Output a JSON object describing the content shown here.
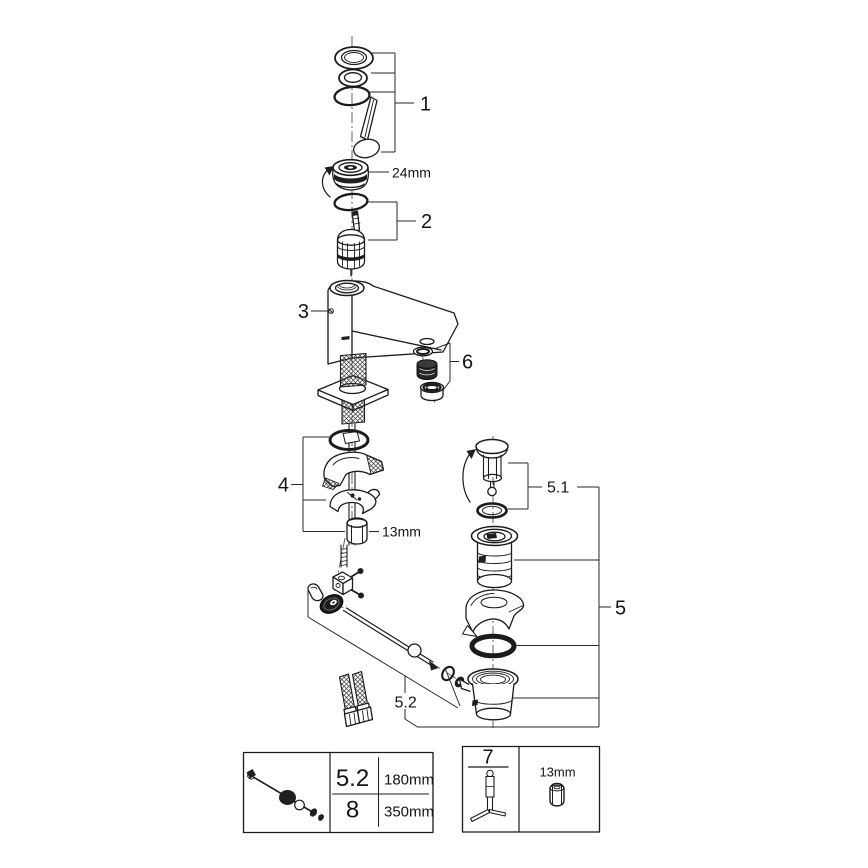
{
  "diagram": {
    "labels": {
      "handle_group": "1",
      "cartridge_group": "2",
      "body": "3",
      "mounting_group": "4",
      "drain_assembly": "5",
      "drain_plug_group": "5.1",
      "rod_group": "5.2",
      "aerator_group": "6",
      "cap_size": "24mm",
      "nut_size": "13mm"
    },
    "spec_box": {
      "rows": [
        {
          "ref": "5.2",
          "value": "180mm"
        },
        {
          "ref": "8",
          "value": "350mm"
        }
      ]
    },
    "tool_box": {
      "ref": "7",
      "size": "13mm"
    },
    "colors": {
      "line": "#1b1b1b",
      "background": "#ffffff"
    }
  }
}
